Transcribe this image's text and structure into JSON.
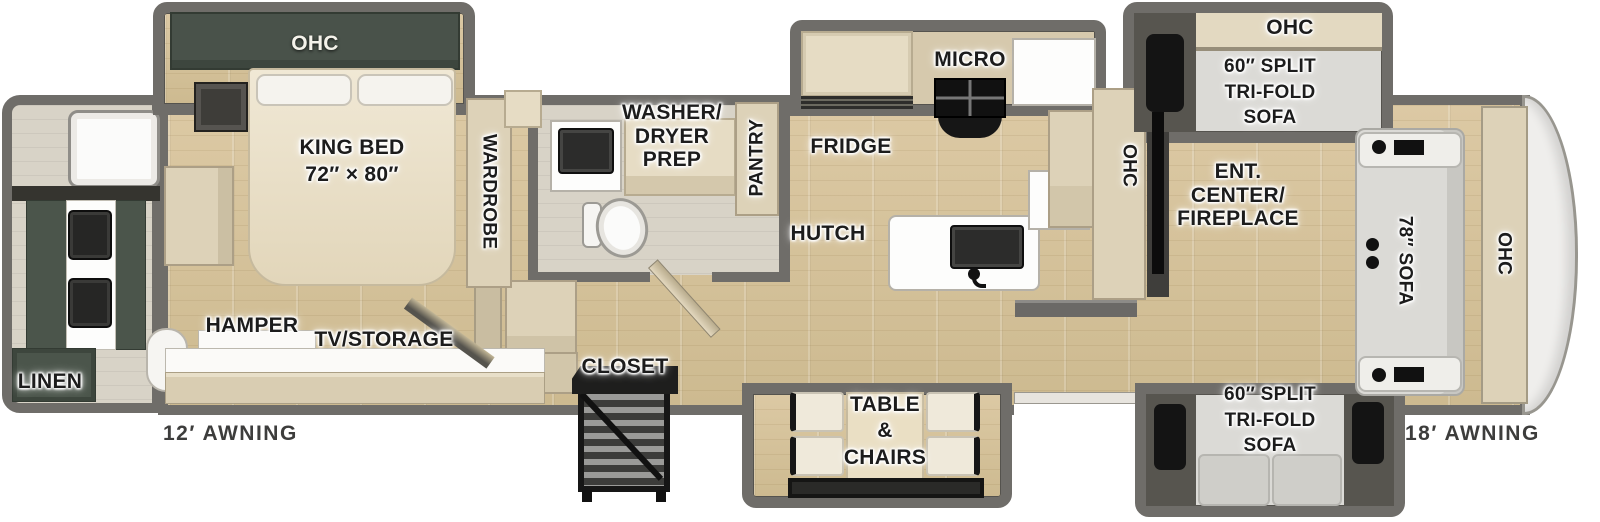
{
  "floorplan": {
    "labels": {
      "bedroom_ohc": "OHC",
      "king_bed": "KING BED\n72″ × 80″",
      "wardrobe": "WARDROBE",
      "washer_dryer_prep": "WASHER/\nDRYER\nPREP",
      "pantry": "PANTRY",
      "linen": "LINEN",
      "hamper": "HAMPER",
      "tv_storage": "TV/STORAGE",
      "closet": "CLOSET",
      "fridge": "FRIDGE",
      "micro": "MICRO",
      "hutch": "HUTCH",
      "kitchen_ohc": "OHC",
      "ent_center": "ENT.\nCENTER/\nFIREPLACE",
      "sofa_slide_top_ohc": "OHC",
      "sofa_slide_top": "60″ SPLIT\nTRI-FOLD\nSOFA",
      "sofa_slide_bottom": "60″ SPLIT\nTRI-FOLD\nSOFA",
      "front_sofa": "78″ SOFA",
      "front_ohc": "OHC",
      "table_chairs": "TABLE\n&\nCHAIRS",
      "awning_left": "12′ AWNING",
      "awning_right": "18′ AWNING"
    },
    "colors": {
      "wall": "#6f6d69",
      "floor_wood": "#d7c49d",
      "cabinet_tan": "#ddd2b8",
      "cabinet_dark_green": "#4b554b",
      "counter_white": "#fdfdfc",
      "appliance_black": "#141414",
      "sofa_gray": "#dbdad6",
      "label_text": "#1c1c1c"
    }
  }
}
